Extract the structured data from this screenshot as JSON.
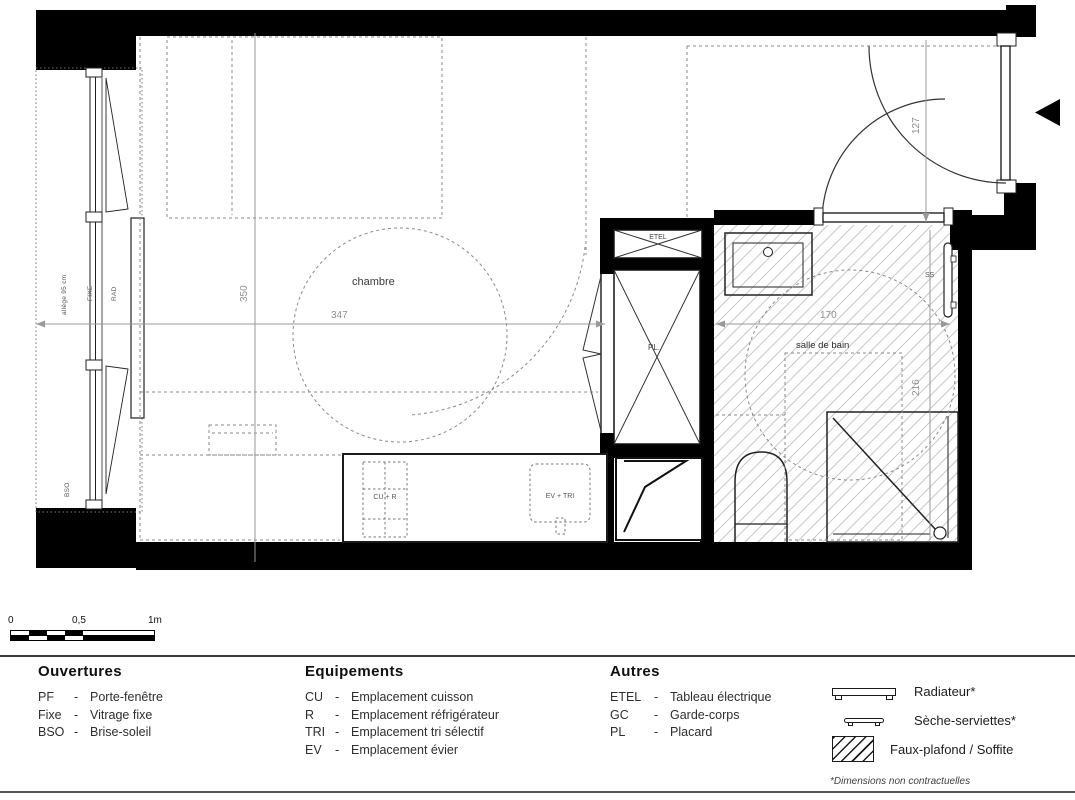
{
  "plan": {
    "bedroom_label": "chambre",
    "bathroom_label": "salle de bain",
    "dim_bedroom_width": "347",
    "dim_bedroom_depth": "350",
    "dim_bathroom_width": "170",
    "dim_bathroom_depth": "216",
    "dim_entry": "127",
    "label_etel": "ETEL",
    "label_pl": "PL.",
    "label_ss": "SS",
    "label_cu_r": "CU + R",
    "label_ev_tri": "EV + TRI",
    "label_fixe": "FIXE",
    "label_rad": "RAD",
    "label_bso": "BSO",
    "label_allege": "allège 95 cm"
  },
  "scale_bar": {
    "tick_start": "0",
    "tick_mid": "0,5",
    "tick_end": "1m"
  },
  "legend": {
    "separator": "-",
    "openings": {
      "title": "Ouvertures",
      "items": [
        {
          "abbr": "PF",
          "label": "Porte-fenêtre"
        },
        {
          "abbr": "Fixe",
          "label": "Vitrage fixe"
        },
        {
          "abbr": "BSO",
          "label": "Brise-soleil"
        }
      ]
    },
    "equipment": {
      "title": "Equipements",
      "items": [
        {
          "abbr": "CU",
          "label": "Emplacement cuisson"
        },
        {
          "abbr": "R",
          "label": "Emplacement réfrigérateur"
        },
        {
          "abbr": "TRI",
          "label": "Emplacement tri sélectif"
        },
        {
          "abbr": "EV",
          "label": "Emplacement évier"
        }
      ]
    },
    "others": {
      "title": "Autres",
      "items": [
        {
          "abbr": "ETEL",
          "label": "Tableau électrique"
        },
        {
          "abbr": "GC",
          "label": "Garde-corps"
        },
        {
          "abbr": "PL",
          "label": "Placard"
        }
      ]
    },
    "symbols": {
      "items": [
        {
          "name": "radiator-symbol",
          "label": "Radiateur*"
        },
        {
          "name": "towel-dryer-symbol",
          "label": "Sèche-serviettes*"
        },
        {
          "name": "soffit-hatch-symbol",
          "label": "Faux-plafond / Soffite"
        }
      ],
      "footnote": "*Dimensions non contractuelles"
    }
  },
  "colors": {
    "wall": "#000000",
    "hatch_line": "#c8c8c8",
    "dashed": "#8a8a8a",
    "dimension": "#909090"
  }
}
